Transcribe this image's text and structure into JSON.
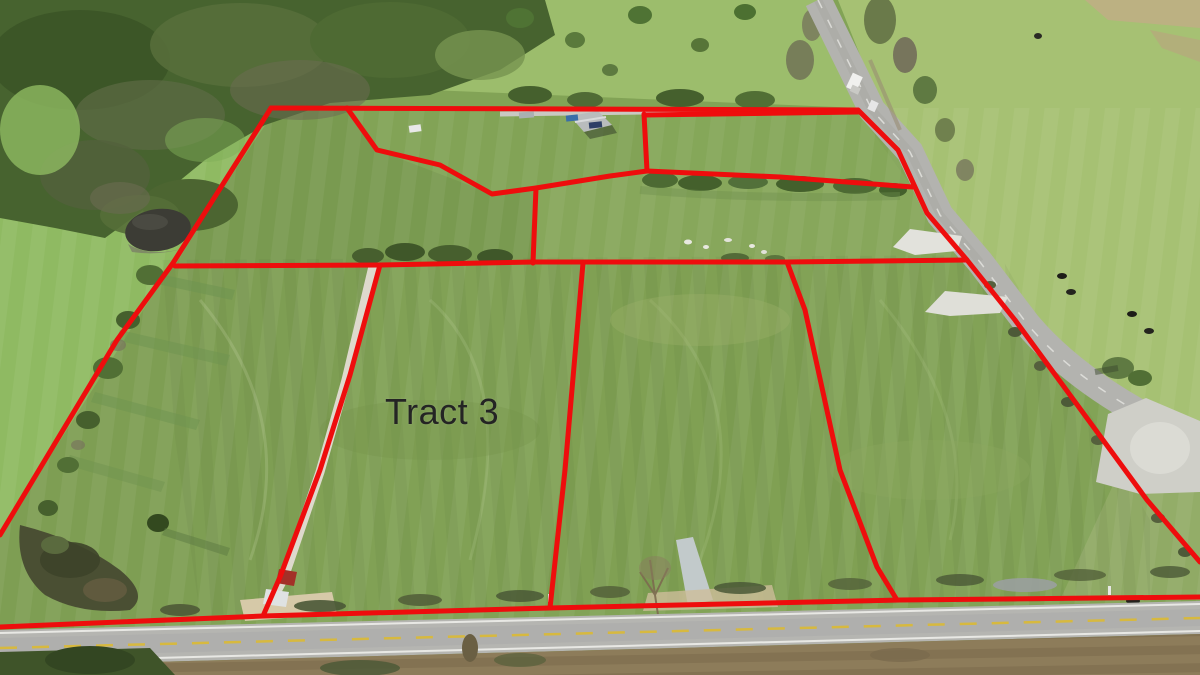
{
  "map": {
    "type": "aerial-tract-survey",
    "label": {
      "text": "Tract 3",
      "x": 385,
      "y": 391,
      "font_size": 36,
      "color": "#242424"
    },
    "boundaries": {
      "color": "#ee0d0d",
      "stroke_width": 5,
      "lines": [
        {
          "name": "outer-top",
          "points": [
            [
              271,
              108
            ],
            [
              858,
              110
            ]
          ]
        },
        {
          "name": "outer-right-road",
          "points": [
            [
              858,
              110
            ],
            [
              898,
              150
            ],
            [
              927,
              213
            ],
            [
              967,
              260
            ],
            [
              1015,
              320
            ],
            [
              1147,
              500
            ],
            [
              1200,
              562
            ]
          ]
        },
        {
          "name": "outer-bottom",
          "points": [
            [
              0,
              627
            ],
            [
              263,
              616
            ],
            [
              550,
              608
            ],
            [
              900,
              600
            ],
            [
              1200,
              597
            ]
          ]
        },
        {
          "name": "outer-left",
          "points": [
            [
              271,
              108
            ],
            [
              173,
              263
            ],
            [
              117,
              340
            ],
            [
              0,
              535
            ]
          ]
        },
        {
          "name": "homestead-notch",
          "points": [
            [
              347,
              108
            ],
            [
              377,
              150
            ],
            [
              440,
              165
            ],
            [
              492,
              194
            ],
            [
              536,
              188
            ],
            [
              610,
              176
            ],
            [
              647,
              171
            ]
          ]
        },
        {
          "name": "homestead-east-tie",
          "points": [
            [
              644,
              114
            ],
            [
              647,
              171
            ]
          ]
        },
        {
          "name": "north-tract-line",
          "points": [
            [
              644,
              115
            ],
            [
              858,
              112
            ]
          ]
        },
        {
          "name": "mid-upper-fence",
          "points": [
            [
              647,
              171
            ],
            [
              780,
              177
            ],
            [
              913,
              187
            ]
          ]
        },
        {
          "name": "mid-line",
          "points": [
            [
              175,
              266
            ],
            [
              380,
              265
            ],
            [
              533,
              262
            ],
            [
              787,
              262
            ],
            [
              967,
              260
            ]
          ]
        },
        {
          "name": "upper-middle-divider",
          "points": [
            [
              536,
              188
            ],
            [
              533,
              263
            ]
          ]
        },
        {
          "name": "divider-west",
          "points": [
            [
              380,
              265
            ],
            [
              350,
              375
            ],
            [
              320,
              470
            ],
            [
              280,
              577
            ],
            [
              263,
              616
            ]
          ]
        },
        {
          "name": "divider-center",
          "points": [
            [
              583,
              263
            ],
            [
              565,
              470
            ],
            [
              550,
              608
            ]
          ]
        },
        {
          "name": "divider-east",
          "points": [
            [
              787,
              262
            ],
            [
              805,
              310
            ],
            [
              840,
              470
            ],
            [
              877,
              567
            ],
            [
              897,
              600
            ]
          ]
        }
      ]
    },
    "scene_colors": {
      "field_green": "#82a356",
      "pale_pasture": "#a6c173",
      "woods_green": "#47632f",
      "road_gray": "#b5b5b1",
      "gravel_white": "#e0e0d8",
      "dirt_brown": "#8d7c5a",
      "pond_dark": "#3c3c35",
      "center_line_yellow": "#d7b93f"
    }
  }
}
